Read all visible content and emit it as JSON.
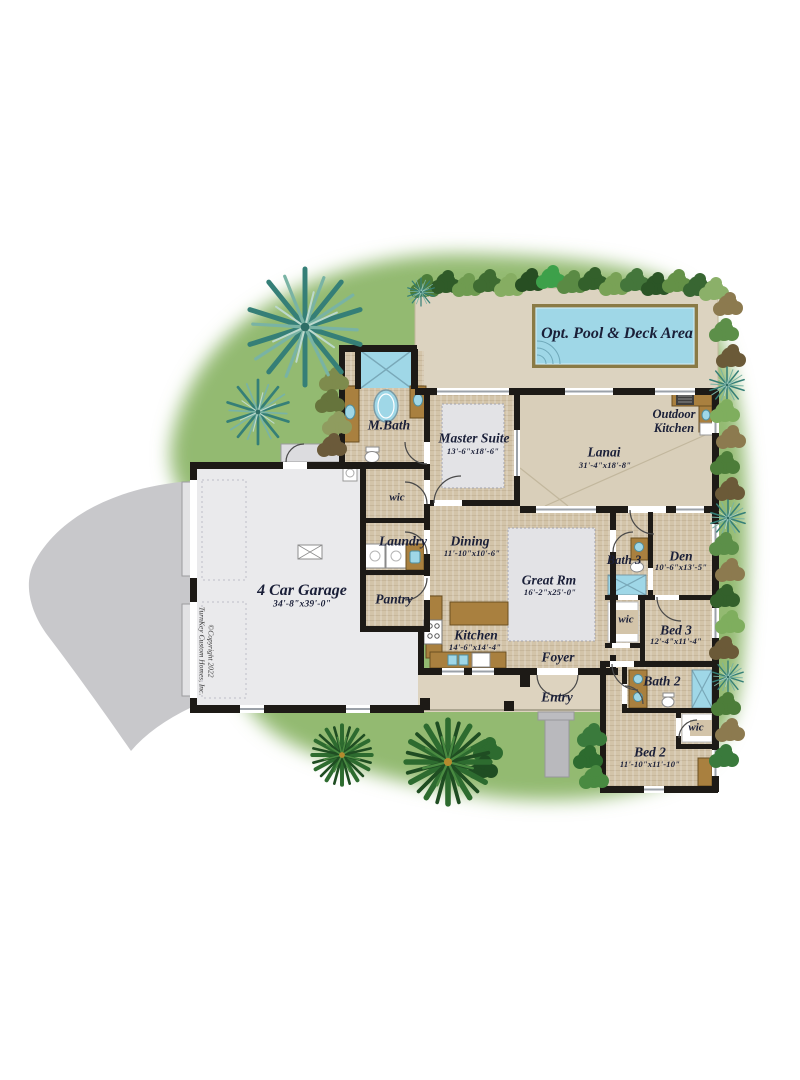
{
  "copyright": {
    "line1": "©Copyright 2022",
    "line2": "TurnKey Custom Homes, Inc."
  },
  "rooms": {
    "pool_deck": {
      "label": "Opt. Pool & Deck Area"
    },
    "outdoor_kitchen": {
      "line1": "Outdoor",
      "line2": "Kitchen"
    },
    "lanai": {
      "label": "Lanai",
      "dims": "31'-4\"x18'-8\""
    },
    "master_suite": {
      "label": "Master Suite",
      "dims": "13'-6\"x18'-6\""
    },
    "master_bath": {
      "label": "M.Bath"
    },
    "master_wic": {
      "label": "wic"
    },
    "laundry": {
      "label": "Laundry"
    },
    "dining": {
      "label": "Dining",
      "dims": "11'-10\"x10'-6\""
    },
    "pantry": {
      "label": "Pantry"
    },
    "kitchen": {
      "label": "Kitchen",
      "dims": "14'-6\"x14'-4\""
    },
    "great_room": {
      "label": "Great Rm",
      "dims": "16'-2\"x25'-0\""
    },
    "garage": {
      "label": "4 Car Garage",
      "dims": "34'-8\"x39'-0\""
    },
    "foyer": {
      "label": "Foyer"
    },
    "entry": {
      "label": "Entry"
    },
    "bath3": {
      "label": "Bath 3"
    },
    "den": {
      "label": "Den",
      "dims": "10'-6\"x13'-5\""
    },
    "bed3_wic": {
      "label": "wic"
    },
    "bed3": {
      "label": "Bed 3",
      "dims": "12'-4\"x11'-4\""
    },
    "bath2": {
      "label": "Bath 2"
    },
    "bed2_wic": {
      "label": "wic"
    },
    "bed2": {
      "label": "Bed 2",
      "dims": "11'-10\"x11'-10\""
    }
  },
  "colors": {
    "grass": "#93ba71",
    "driveway": "#c8c8cb",
    "garage_floor": "#eaeaec",
    "tile": "#d3c4a9",
    "deck": "#dcd3c0",
    "pool_water": "#9fd7e7",
    "pool_coping": "#8a7a45",
    "cabinet_brown": "#a9803f",
    "wall_black": "#1d1a16"
  }
}
